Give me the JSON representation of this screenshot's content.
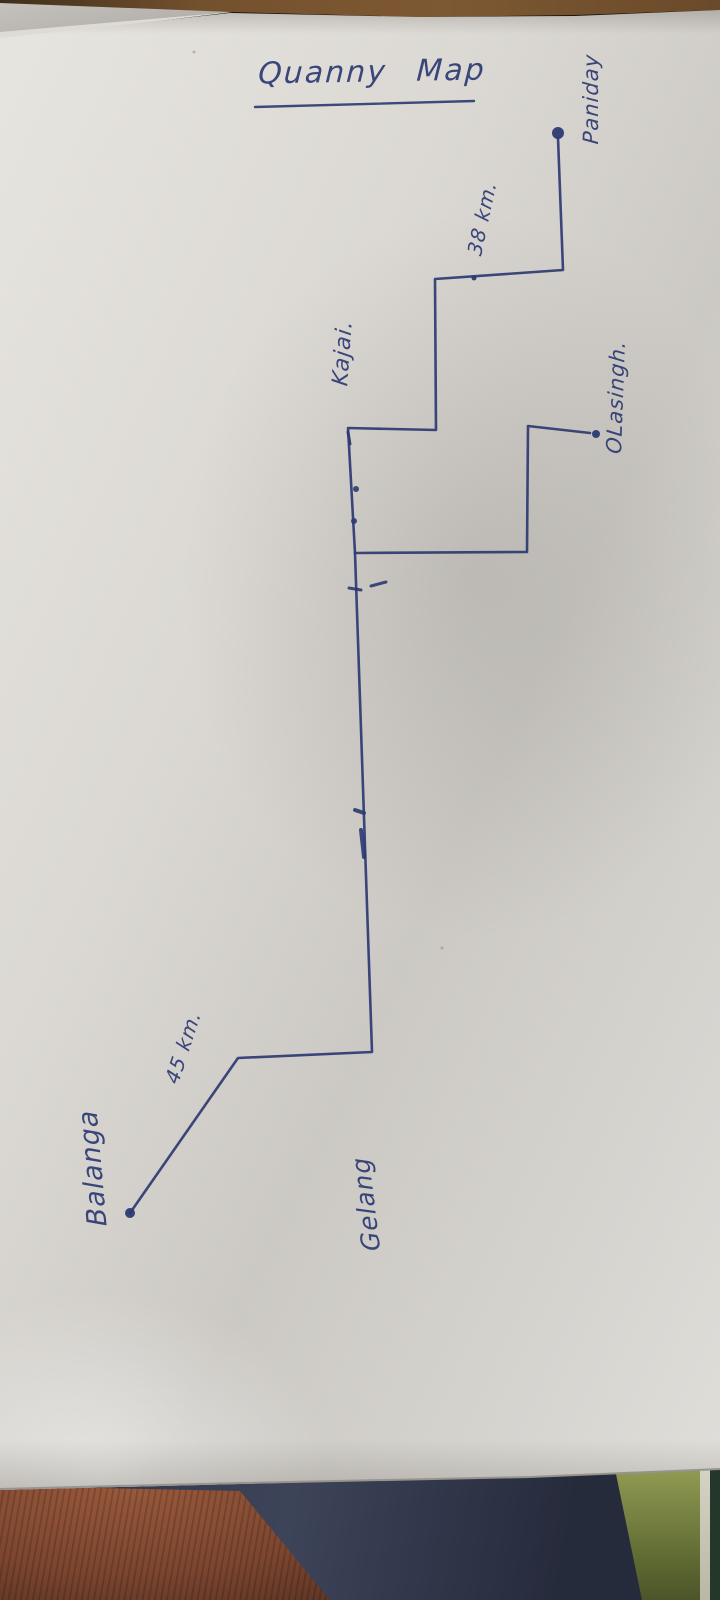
{
  "photo": {
    "scene": "hand-drawn route map in blue ink on a white sheet of paper, photographed on a table with fabric visible at the bottom edge",
    "paper_color": "#dcdad5",
    "table_color": "#74512e",
    "fabric_colors": {
      "left_orange": "#7c452f",
      "middle_navy": "#323950",
      "right_olive": "#6b7539",
      "right_light_stripe": "#cfcdbd",
      "right_dark_green": "#24372a"
    }
  },
  "ink": {
    "color": "#2c3a72"
  },
  "map": {
    "title": {
      "text": "Quanny Map",
      "x": 372,
      "y": 72,
      "rotation": -1,
      "font_size": 30,
      "underline": {
        "x1": 255,
        "y1": 107,
        "x2": 474,
        "y2": 101,
        "width": 2.4
      }
    },
    "labels": [
      {
        "name": "place-label-balanga",
        "text": "Balanga",
        "x": 93,
        "y": 1168,
        "rotation": -95,
        "font_size": 27
      },
      {
        "name": "distance-label-45km",
        "text": "45 km.",
        "x": 183,
        "y": 1047,
        "rotation": -72,
        "font_size": 20
      },
      {
        "name": "place-label-gelang",
        "text": "Gelang",
        "x": 366,
        "y": 1204,
        "rotation": -97,
        "font_size": 25
      },
      {
        "name": "place-label-kajai",
        "text": "Kajai.",
        "x": 343,
        "y": 353,
        "rotation": -86,
        "font_size": 22
      },
      {
        "name": "distance-label-38km",
        "text": "38 km.",
        "x": 482,
        "y": 218,
        "rotation": -78,
        "font_size": 20
      },
      {
        "name": "place-label-olasingh",
        "text": "OLasingh.",
        "x": 616,
        "y": 397,
        "rotation": -88,
        "font_size": 21
      },
      {
        "name": "place-label-paniday",
        "text": "Paniday",
        "x": 591,
        "y": 99,
        "rotation": -90,
        "font_size": 21
      }
    ],
    "routes": [
      {
        "name": "route-balanga-to-paniday",
        "width": 2.6,
        "points": [
          [
            130,
            1213
          ],
          [
            238,
            1058
          ],
          [
            372,
            1052
          ],
          [
            355,
            553
          ],
          [
            348,
            428
          ],
          [
            436,
            430
          ],
          [
            435,
            279
          ],
          [
            563,
            270
          ],
          [
            558,
            138
          ]
        ]
      },
      {
        "name": "route-branch-to-olasingh",
        "width": 2.6,
        "points": [
          [
            355,
            553
          ],
          [
            527,
            552
          ],
          [
            528,
            426
          ],
          [
            590,
            433
          ]
        ]
      }
    ],
    "dots": [
      {
        "name": "balanga-dot",
        "x": 130,
        "y": 1213,
        "r": 5
      },
      {
        "name": "paniday-dot",
        "x": 558,
        "y": 133,
        "r": 6
      },
      {
        "name": "olasingh-dot",
        "x": 596,
        "y": 434,
        "r": 4
      },
      {
        "name": "kajai-route-dot",
        "x": 474,
        "y": 278,
        "r": 2.5
      }
    ],
    "marks": [
      {
        "name": "route-tick",
        "type": "line",
        "x1": 355,
        "y1": 810,
        "x2": 364,
        "y2": 813,
        "w": 4
      },
      {
        "name": "route-retrace",
        "type": "line",
        "x1": 361,
        "y1": 830,
        "x2": 364,
        "y2": 857,
        "w": 4
      },
      {
        "name": "route-dash-1",
        "type": "line",
        "x1": 349,
        "y1": 588,
        "x2": 361,
        "y2": 590,
        "w": 3
      },
      {
        "name": "route-dash-2",
        "type": "line",
        "x1": 371,
        "y1": 586,
        "x2": 386,
        "y2": 582,
        "w": 3
      },
      {
        "name": "corner-tick",
        "type": "line",
        "x1": 348,
        "y1": 432,
        "x2": 350,
        "y2": 444,
        "w": 3
      },
      {
        "name": "route-dot-1",
        "type": "circle",
        "x": 356,
        "y": 489,
        "r": 3
      },
      {
        "name": "route-dot-2",
        "type": "circle",
        "x": 354,
        "y": 521,
        "r": 3
      },
      {
        "name": "ink-speck-1",
        "type": "circle",
        "x": 442,
        "y": 948,
        "r": 1.5,
        "faint": true
      },
      {
        "name": "ink-speck-2",
        "type": "circle",
        "x": 194,
        "y": 52,
        "r": 1.5,
        "faint": true
      }
    ],
    "paper_edges": [
      {
        "name": "paper-bottom-edge",
        "points": [
          [
            0,
            1489
          ],
          [
            240,
            1483
          ],
          [
            530,
            1477
          ],
          [
            720,
            1469
          ]
        ],
        "color": "#97948d",
        "w": 2
      }
    ]
  }
}
